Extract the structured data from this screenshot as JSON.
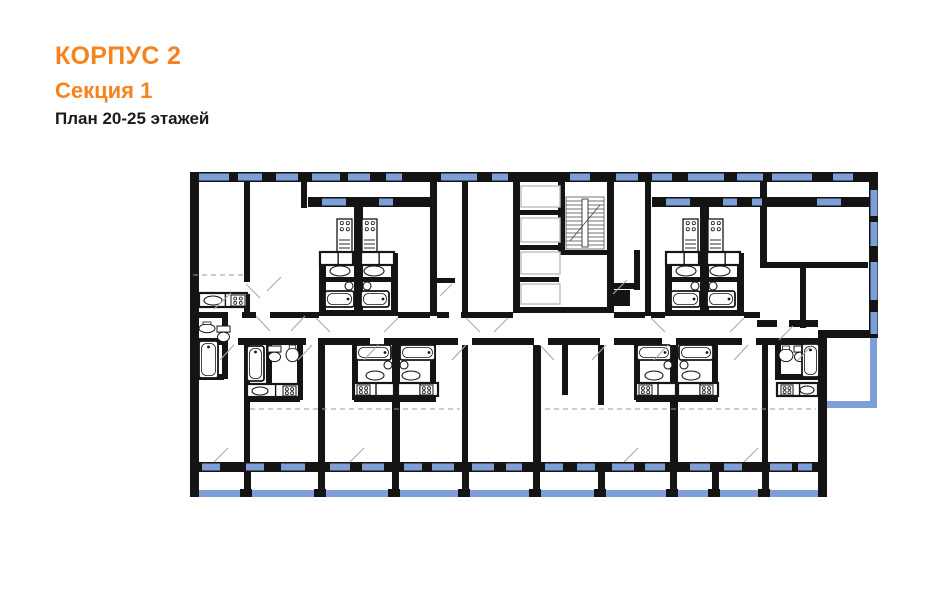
{
  "header": {
    "building": "КОРПУС 2",
    "section": "Секция 1",
    "plan": "План 20-25 этажей"
  },
  "colors": {
    "accent": "#F5831F",
    "wall": "#141414",
    "window": "#7D9ED6",
    "door_line": "#a9a9a9",
    "dash_line": "#9a9a9a",
    "elevator_stroke": "#bdbdbd",
    "fixture_stroke": "#161616",
    "background": "#ffffff"
  },
  "floorplan": {
    "canvas": {
      "w": 941,
      "h": 600
    },
    "walls": [
      [
        190,
        172,
        688,
        10
      ],
      [
        190,
        172,
        9,
        325
      ],
      [
        869,
        172,
        9,
        166
      ],
      [
        818,
        330,
        9,
        167
      ],
      [
        827,
        330,
        51,
        8
      ],
      [
        190,
        462,
        637,
        10
      ],
      [
        513,
        182,
        7,
        131
      ],
      [
        558,
        182,
        7,
        70
      ],
      [
        607,
        182,
        7,
        131
      ],
      [
        513,
        210,
        46,
        5
      ],
      [
        513,
        245,
        46,
        5
      ],
      [
        513,
        277,
        46,
        5
      ],
      [
        513,
        307,
        101,
        6
      ],
      [
        560,
        250,
        54,
        5
      ],
      [
        634,
        250,
        6,
        40
      ],
      [
        607,
        283,
        33,
        6
      ],
      [
        244,
        182,
        6,
        100
      ],
      [
        244,
        294,
        6,
        24
      ],
      [
        301,
        182,
        6,
        26
      ],
      [
        308,
        197,
        124,
        10
      ],
      [
        354,
        207,
        9,
        108
      ],
      [
        319,
        253,
        7,
        62
      ],
      [
        391,
        253,
        7,
        62
      ],
      [
        321,
        277,
        75,
        5
      ],
      [
        319,
        310,
        79,
        6
      ],
      [
        430,
        182,
        7,
        134
      ],
      [
        462,
        182,
        6,
        134
      ],
      [
        430,
        278,
        25,
        5
      ],
      [
        430,
        283,
        7,
        27
      ],
      [
        645,
        182,
        6,
        134
      ],
      [
        652,
        197,
        96,
        10
      ],
      [
        748,
        197,
        121,
        10
      ],
      [
        700,
        207,
        9,
        108
      ],
      [
        665,
        253,
        7,
        62
      ],
      [
        737,
        253,
        7,
        62
      ],
      [
        667,
        277,
        75,
        5
      ],
      [
        665,
        310,
        79,
        6
      ],
      [
        760,
        182,
        7,
        86
      ],
      [
        760,
        262,
        108,
        6
      ],
      [
        800,
        268,
        6,
        60
      ],
      [
        198,
        312,
        30,
        6
      ],
      [
        242,
        312,
        14,
        6
      ],
      [
        270,
        312,
        49,
        6
      ],
      [
        398,
        312,
        32,
        6
      ],
      [
        437,
        312,
        12,
        6
      ],
      [
        461,
        312,
        52,
        6
      ],
      [
        614,
        312,
        31,
        6
      ],
      [
        651,
        312,
        14,
        6
      ],
      [
        744,
        312,
        16,
        6
      ],
      [
        757,
        320,
        20,
        7
      ],
      [
        789,
        320,
        29,
        7
      ],
      [
        198,
        338,
        26,
        7
      ],
      [
        238,
        338,
        68,
        7
      ],
      [
        318,
        338,
        52,
        7
      ],
      [
        384,
        338,
        74,
        7
      ],
      [
        472,
        338,
        62,
        7
      ],
      [
        548,
        338,
        52,
        7
      ],
      [
        614,
        338,
        48,
        7
      ],
      [
        676,
        338,
        66,
        7
      ],
      [
        756,
        338,
        62,
        7
      ],
      [
        222,
        313,
        6,
        66
      ],
      [
        199,
        374,
        25,
        6
      ],
      [
        244,
        345,
        6,
        117
      ],
      [
        266,
        345,
        6,
        55
      ],
      [
        246,
        396,
        54,
        6
      ],
      [
        297,
        345,
        6,
        55
      ],
      [
        318,
        345,
        7,
        117
      ],
      [
        352,
        345,
        6,
        55
      ],
      [
        354,
        396,
        82,
        6
      ],
      [
        392,
        345,
        8,
        117
      ],
      [
        430,
        345,
        6,
        55
      ],
      [
        462,
        345,
        6,
        117
      ],
      [
        533,
        345,
        8,
        117
      ],
      [
        562,
        345,
        6,
        50
      ],
      [
        598,
        345,
        6,
        60
      ],
      [
        634,
        345,
        6,
        55
      ],
      [
        636,
        396,
        82,
        6
      ],
      [
        670,
        345,
        8,
        117
      ],
      [
        712,
        345,
        6,
        55
      ],
      [
        762,
        345,
        6,
        117
      ],
      [
        775,
        345,
        6,
        33
      ],
      [
        775,
        374,
        43,
        6
      ],
      [
        244,
        472,
        7,
        24
      ],
      [
        318,
        472,
        7,
        24
      ],
      [
        392,
        472,
        7,
        24
      ],
      [
        462,
        472,
        7,
        24
      ],
      [
        533,
        472,
        7,
        24
      ],
      [
        598,
        472,
        7,
        24
      ],
      [
        670,
        472,
        7,
        24
      ],
      [
        712,
        472,
        7,
        24
      ],
      [
        762,
        472,
        7,
        24
      ],
      [
        240,
        489,
        12,
        8
      ],
      [
        314,
        489,
        12,
        8
      ],
      [
        388,
        489,
        12,
        8
      ],
      [
        458,
        489,
        12,
        8
      ],
      [
        529,
        489,
        12,
        8
      ],
      [
        594,
        489,
        12,
        8
      ],
      [
        666,
        489,
        12,
        8
      ],
      [
        708,
        489,
        12,
        8
      ],
      [
        758,
        489,
        12,
        8
      ],
      [
        610,
        290,
        20,
        16
      ]
    ],
    "railings": [
      [
        199,
        490,
        628,
        7
      ],
      [
        870,
        338,
        7,
        66
      ],
      [
        827,
        401,
        50,
        7
      ]
    ],
    "windows": [
      [
        199,
        173.5,
        30,
        7
      ],
      [
        238,
        173.5,
        24,
        7
      ],
      [
        276,
        173.5,
        22,
        7
      ],
      [
        312,
        173.5,
        28,
        7
      ],
      [
        348,
        173.5,
        22,
        7
      ],
      [
        386,
        173.5,
        16,
        7
      ],
      [
        441,
        173.5,
        36,
        7
      ],
      [
        492,
        173.5,
        16,
        7
      ],
      [
        570,
        173.5,
        20,
        7
      ],
      [
        616,
        173.5,
        22,
        7
      ],
      [
        652,
        173.5,
        20,
        7
      ],
      [
        688,
        173.5,
        36,
        7
      ],
      [
        737,
        173.5,
        26,
        7
      ],
      [
        772,
        173.5,
        40,
        7
      ],
      [
        833,
        173.5,
        20,
        7
      ],
      [
        322,
        198.5,
        24,
        7
      ],
      [
        379,
        198.5,
        14,
        7
      ],
      [
        666,
        198.5,
        24,
        7
      ],
      [
        723,
        198.5,
        14,
        7
      ],
      [
        752,
        198.5,
        10,
        7
      ],
      [
        817,
        198.5,
        24,
        7
      ],
      [
        870.5,
        190,
        7,
        26
      ],
      [
        870.5,
        222,
        7,
        24
      ],
      [
        870.5,
        262,
        7,
        38
      ],
      [
        870.5,
        312,
        7,
        22
      ],
      [
        202,
        463.5,
        18,
        7
      ],
      [
        246,
        463.5,
        18,
        7
      ],
      [
        281,
        463.5,
        24,
        7
      ],
      [
        330,
        463.5,
        20,
        7
      ],
      [
        362,
        463.5,
        22,
        7
      ],
      [
        404,
        463.5,
        18,
        7
      ],
      [
        432,
        463.5,
        22,
        7
      ],
      [
        472,
        463.5,
        22,
        7
      ],
      [
        506,
        463.5,
        16,
        7
      ],
      [
        545,
        463.5,
        18,
        7
      ],
      [
        577,
        463.5,
        18,
        7
      ],
      [
        612,
        463.5,
        22,
        7
      ],
      [
        645,
        463.5,
        20,
        7
      ],
      [
        690,
        463.5,
        20,
        7
      ],
      [
        724,
        463.5,
        18,
        7
      ],
      [
        770,
        463.5,
        22,
        7
      ],
      [
        798,
        463.5,
        14,
        7
      ]
    ],
    "elevators": [
      [
        521,
        186,
        39,
        21
      ],
      [
        521,
        218,
        39,
        24
      ],
      [
        521,
        252,
        39,
        22
      ],
      [
        521,
        284,
        39,
        20
      ]
    ],
    "stairs": {
      "x": 566,
      "y": 197,
      "w": 38,
      "h": 52,
      "treads": 12
    },
    "fixtures": [
      [
        "counter",
        199,
        293,
        48,
        14
      ],
      [
        "stove4",
        231,
        295,
        14,
        11
      ],
      [
        "sinko",
        204,
        296,
        18,
        9
      ],
      [
        "basin",
        199,
        322,
        16,
        11
      ],
      [
        "toilet",
        217,
        326,
        13,
        16
      ],
      [
        "tubv",
        199,
        341,
        19,
        37
      ],
      [
        "stovecol",
        337,
        219,
        15,
        34
      ],
      [
        "stovecol",
        362,
        219,
        15,
        34
      ],
      [
        "counter",
        320,
        252,
        33,
        13
      ],
      [
        "counter",
        361,
        252,
        33,
        13
      ],
      [
        "sinko",
        330,
        266,
        20,
        10
      ],
      [
        "sinko",
        364,
        266,
        20,
        10
      ],
      [
        "circ",
        349,
        286,
        4
      ],
      [
        "circ",
        367,
        286,
        4
      ],
      [
        "tubh",
        325,
        291,
        29,
        16
      ],
      [
        "tubh",
        361,
        291,
        28,
        16
      ],
      [
        "stovecol",
        683,
        219,
        15,
        34
      ],
      [
        "stovecol",
        708,
        219,
        15,
        34
      ],
      [
        "counter",
        666,
        252,
        33,
        13
      ],
      [
        "counter",
        707,
        252,
        33,
        13
      ],
      [
        "sinko",
        676,
        266,
        20,
        10
      ],
      [
        "sinko",
        710,
        266,
        20,
        10
      ],
      [
        "circ",
        695,
        286,
        4
      ],
      [
        "circ",
        713,
        286,
        4
      ],
      [
        "tubh",
        671,
        291,
        29,
        16
      ],
      [
        "tubh",
        707,
        291,
        28,
        16
      ],
      [
        "tubv",
        247,
        346,
        17,
        35
      ],
      [
        "toilet",
        268,
        346,
        13,
        16
      ],
      [
        "basin",
        286,
        345,
        13,
        17
      ],
      [
        "counter",
        247,
        384,
        52,
        13
      ],
      [
        "stove4",
        283,
        386,
        13,
        10
      ],
      [
        "sinko",
        252,
        387,
        16,
        8
      ],
      [
        "tubh",
        356,
        345,
        35,
        15
      ],
      [
        "tubh",
        400,
        345,
        35,
        15
      ],
      [
        "circ",
        388,
        365,
        4
      ],
      [
        "circ",
        404,
        365,
        4
      ],
      [
        "sinko",
        366,
        371,
        18,
        9
      ],
      [
        "sinko",
        402,
        371,
        18,
        9
      ],
      [
        "counter",
        354,
        383,
        40,
        13
      ],
      [
        "counter",
        398,
        383,
        40,
        13
      ],
      [
        "stove4",
        357,
        385,
        13,
        10
      ],
      [
        "stove4",
        420,
        385,
        13,
        10
      ],
      [
        "tubh",
        637,
        345,
        34,
        15
      ],
      [
        "tubh",
        679,
        345,
        34,
        15
      ],
      [
        "circ",
        668,
        365,
        4
      ],
      [
        "circ",
        684,
        365,
        4
      ],
      [
        "sinko",
        645,
        371,
        18,
        9
      ],
      [
        "sinko",
        682,
        371,
        18,
        9
      ],
      [
        "counter",
        636,
        383,
        40,
        13
      ],
      [
        "counter",
        678,
        383,
        40,
        13
      ],
      [
        "stove4",
        639,
        385,
        13,
        10
      ],
      [
        "stove4",
        700,
        385,
        13,
        10
      ],
      [
        "basin",
        779,
        346,
        14,
        16
      ],
      [
        "toilet",
        794,
        346,
        12,
        16
      ],
      [
        "tubv",
        802,
        344,
        17,
        33
      ],
      [
        "counter",
        777,
        383,
        41,
        13
      ],
      [
        "stove4",
        781,
        385,
        12,
        10
      ],
      [
        "sinko",
        800,
        386,
        14,
        8
      ]
    ],
    "doors": [
      [
        231,
        293,
        214,
        309
      ],
      [
        256,
        316,
        270,
        331
      ],
      [
        305,
        316,
        291,
        331
      ],
      [
        316,
        318,
        330,
        332
      ],
      [
        398,
        318,
        384,
        332
      ],
      [
        452,
        284,
        440,
        296
      ],
      [
        466,
        318,
        480,
        332
      ],
      [
        651,
        318,
        665,
        332
      ],
      [
        744,
        318,
        730,
        332
      ],
      [
        793,
        326,
        779,
        340
      ],
      [
        281,
        277,
        267,
        291
      ],
      [
        627,
        280,
        613,
        294
      ],
      [
        246,
        284,
        260,
        298
      ],
      [
        508,
        318,
        494,
        332
      ],
      [
        234,
        345,
        220,
        360
      ],
      [
        312,
        345,
        298,
        360
      ],
      [
        378,
        345,
        364,
        360
      ],
      [
        466,
        345,
        452,
        360
      ],
      [
        540,
        345,
        554,
        360
      ],
      [
        606,
        345,
        592,
        360
      ],
      [
        668,
        345,
        654,
        360
      ],
      [
        748,
        345,
        734,
        360
      ],
      [
        812,
        345,
        798,
        360
      ],
      [
        214,
        462,
        228,
        448
      ],
      [
        350,
        462,
        364,
        448
      ],
      [
        624,
        462,
        638,
        448
      ],
      [
        744,
        462,
        758,
        448
      ]
    ],
    "dashes": [
      [
        193,
        275,
        243,
        275
      ],
      [
        250,
        409,
        460,
        409
      ],
      [
        545,
        409,
        816,
        409
      ]
    ]
  }
}
